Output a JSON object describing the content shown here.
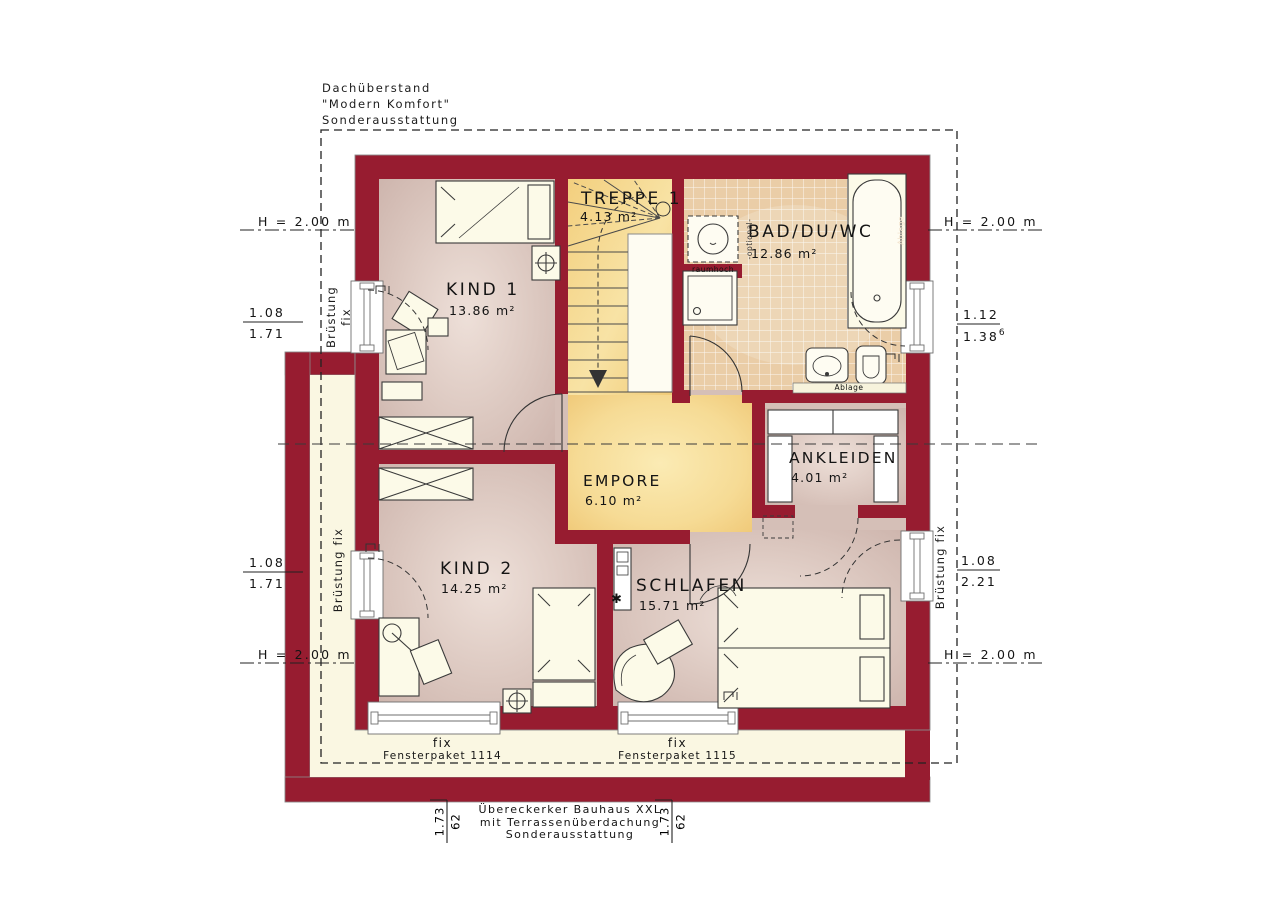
{
  "header_note": {
    "line1": "Dachüberstand",
    "line2": "\"Modern Komfort\"",
    "line3": "Sonderausstattung"
  },
  "footer_note": {
    "line1": "Übereckerker Bauhaus XXL",
    "line2": "mit Terrassenüberdachung",
    "line3": "Sonderausstattung"
  },
  "rooms": {
    "treppe": {
      "name": "TREPPE 1",
      "area": "4.13 m²"
    },
    "bad": {
      "name": "BAD/DU/WC",
      "area": "12.86 m²"
    },
    "kind1": {
      "name": "KIND 1",
      "area": "13.86 m²"
    },
    "empore": {
      "name": "EMPORE",
      "area": "6.10 m²"
    },
    "ankleiden": {
      "name": "ANKLEIDEN",
      "area": "4.01 m²"
    },
    "kind2": {
      "name": "KIND 2",
      "area": "14.25 m²"
    },
    "schlafen": {
      "name": "SCHLAFEN",
      "area": "15.71 m²"
    }
  },
  "dims": {
    "h_left_top": "H = 2.00 m",
    "h_right_top": "H = 2.00 m",
    "h_left_bottom": "H = 2.00 m",
    "h_right_bottom": "H = 2.00 m",
    "win_left_top_num": "1.08",
    "win_left_top_den": "1.71",
    "win_right_top_num": "1.12",
    "win_right_top_den": "1.38",
    "win_right_top_sup": "6",
    "win_left_bottom_num": "1.08",
    "win_left_bottom_den": "1.71",
    "win_right_bottom_num": "1.08",
    "win_right_bottom_den": "2.21",
    "sill_left_top": "Brüstung fix",
    "sill_left_bottom": "Brüstung fix",
    "sill_right_bottom": "Brüstung fix",
    "bottom_left_a": "1.73",
    "bottom_left_b": "62",
    "bottom_right_a": "1.73",
    "bottom_right_b": "62"
  },
  "windows": {
    "pkg1": {
      "fix": "fix",
      "label": "Fensterpaket 1114"
    },
    "pkg2": {
      "fix": "fix",
      "label": "Fensterpaket 1115"
    }
  },
  "bath": {
    "raumhoch": "raumhoch",
    "optional": "-optional-",
    "ablage_side": "Ablage",
    "ablage_bottom": "Ablage"
  },
  "symbols": {
    "star": "✱"
  },
  "colors": {
    "wall": "#971C30",
    "floor_pink": "#D5BFB7",
    "floor_yellow": "#F4D385",
    "floor_tile": "#EACDA7",
    "terrace": "#FAF7E2",
    "furniture": "#FCFAE8"
  }
}
